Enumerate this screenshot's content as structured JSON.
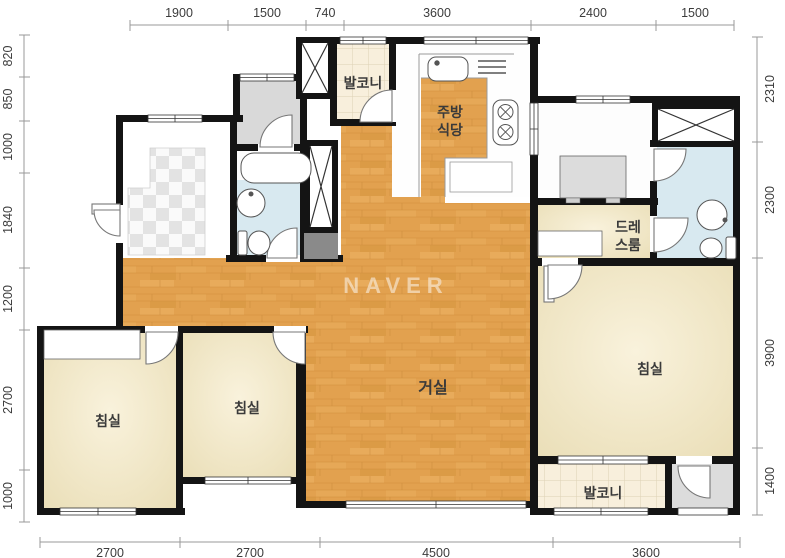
{
  "watermark": "NAVER",
  "rooms": {
    "balcony_top": "발코니",
    "kitchen_line1": "주방",
    "kitchen_line2": "식당",
    "dress_room_line1": "드레",
    "dress_room_line2": "스룸",
    "living_room": "거실",
    "bedroom": "침실",
    "balcony_bottom": "발코니"
  },
  "dimensions_mm": {
    "top": [
      "1900",
      "1500",
      "740",
      "3600",
      "2400",
      "1500"
    ],
    "left": [
      "820",
      "850",
      "1000",
      "1840",
      "1200",
      "2700",
      "1000"
    ],
    "right": [
      "2310",
      "2300",
      "3900",
      "1400"
    ],
    "bottom": [
      "2700",
      "2700",
      "4500",
      "3600"
    ]
  },
  "colors": {
    "wall": "#141414",
    "wood_floor": "#e2a14f",
    "bedroom_floor": "#f2e8c8",
    "bathroom_floor": "#d8e9f0",
    "balcony_floor": "#f8efdc",
    "utility_floor": "#d9d9d9"
  }
}
